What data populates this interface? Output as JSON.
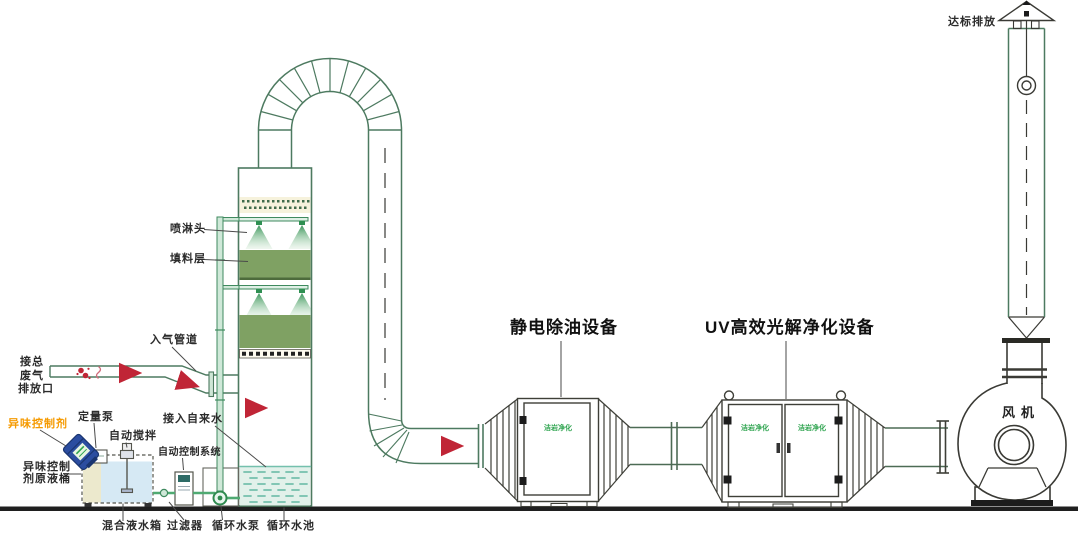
{
  "labels": {
    "waste_gas_line1": "接总",
    "waste_gas_line2": "废气",
    "waste_gas_line3": "排放口",
    "inlet_duct": "入气管道",
    "spray_head": "喷淋头",
    "packing_layer": "填料层",
    "odor_control_agent": "异味控制剂",
    "dosing_pump": "定量泵",
    "auto_stir": "自动搅拌",
    "auto_control_system": "自动控制系统",
    "tap_water": "接入自来水",
    "agent_barrel_line1": "异味控制",
    "agent_barrel_line2": "剂原液桶",
    "mixing_tank": "混合液水箱",
    "filter": "过滤器",
    "circulating_pump": "循环水泵",
    "circulating_pool": "循环水池",
    "electrostatic_unit": "静电除油设备",
    "uv_unit": "UV高效光解净化设备",
    "fan": "风机",
    "compliant_emission": "达标排放",
    "brand_logo": "洁岩净化"
  },
  "colors": {
    "pipe_green": "#3f8a5f",
    "outline_green": "#4d7a60",
    "hardware_gray": "#3e3f38",
    "packing_green": "#7fa163",
    "spray_green": "#2f8f52",
    "demister_cream": "#f6f2dc",
    "pool_fill": "#e2f1ea",
    "pool_dash": "#74c0ad",
    "tank_water": "#d6e9f4",
    "barrel_blue": "#2b4da0",
    "arrow_red": "#c02536",
    "label_orange": "#f59a00",
    "logo_green": "#2ea44f",
    "ground_black": "#1f1f1f"
  }
}
